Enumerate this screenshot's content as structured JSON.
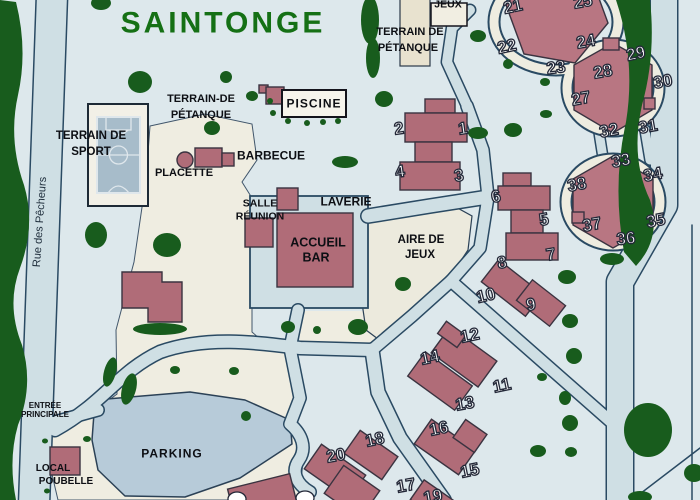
{
  "map": {
    "title": "SAINTONGE",
    "street_name": "Rue des Pêcheurs",
    "labels": {
      "petanque_top": {
        "line1": "TERRAIN DE",
        "line2": "PÉTANQUE"
      },
      "jeux_box": "JEUX",
      "piscine": "PISCINE",
      "petanque_left": {
        "line1": "TERRAIN-DE",
        "line2": "PÉTANQUE"
      },
      "terrain_sport": {
        "line1": "TERRAIN DE",
        "line2": "SPORT"
      },
      "barbecue": "BARBECUE",
      "placette": "PLACETTE",
      "salle_reunion": {
        "line1": "SALLE",
        "line2": "RÉUNION"
      },
      "laverie": "LAVERIE",
      "accueil_bar": {
        "line1": "ACCUEIL",
        "line2": "BAR"
      },
      "aire_de_jeux": {
        "line1": "AIRE DE",
        "line2": "JEUX"
      },
      "entree": {
        "line1": "ENTRÉE",
        "line2": "PRINCIPALE"
      },
      "local_poubelle": {
        "line1": "LOCAL",
        "line2": "POUBELLE"
      },
      "parking": "PARKING"
    },
    "colors": {
      "background": "#dde8ec",
      "zone_cream": "#efede1",
      "road_fill": "#cfdfe4",
      "road_casing": "#2a4a63",
      "parking_fill": "#b7cbd9",
      "building_fill": "#b06c78",
      "building_hex_fill": "#b87682",
      "tree_green": "#185c1d",
      "title_green": "#157015",
      "number_fill": "#ffffff",
      "number_outline": "#232838"
    },
    "sites": [
      {
        "n": "1",
        "x": 463,
        "y": 129,
        "r": -8
      },
      {
        "n": "2",
        "x": 399,
        "y": 129,
        "r": -8
      },
      {
        "n": "3",
        "x": 459,
        "y": 176,
        "r": -8
      },
      {
        "n": "4",
        "x": 400,
        "y": 172,
        "r": -8
      },
      {
        "n": "5",
        "x": 544,
        "y": 220,
        "r": -10
      },
      {
        "n": "6",
        "x": 496,
        "y": 197,
        "r": -10
      },
      {
        "n": "7",
        "x": 551,
        "y": 255,
        "r": -10
      },
      {
        "n": "8",
        "x": 502,
        "y": 263,
        "r": -10
      },
      {
        "n": "9",
        "x": 531,
        "y": 305,
        "r": -10
      },
      {
        "n": "10",
        "x": 486,
        "y": 296,
        "r": -14
      },
      {
        "n": "11",
        "x": 502,
        "y": 386,
        "r": -12
      },
      {
        "n": "12",
        "x": 470,
        "y": 336,
        "r": -12
      },
      {
        "n": "13",
        "x": 465,
        "y": 404,
        "r": -10
      },
      {
        "n": "14",
        "x": 430,
        "y": 358,
        "r": -12
      },
      {
        "n": "15",
        "x": 470,
        "y": 471,
        "r": -12
      },
      {
        "n": "16",
        "x": 439,
        "y": 429,
        "r": -12
      },
      {
        "n": "17",
        "x": 406,
        "y": 486,
        "r": -10
      },
      {
        "n": "18",
        "x": 375,
        "y": 440,
        "r": -12
      },
      {
        "n": "19",
        "x": 433,
        "y": 497,
        "r": -10
      },
      {
        "n": "20",
        "x": 336,
        "y": 456,
        "r": -10
      },
      {
        "n": "21",
        "x": 513,
        "y": 7,
        "r": -12
      },
      {
        "n": "22",
        "x": 507,
        "y": 47,
        "r": -12
      },
      {
        "n": "23",
        "x": 556,
        "y": 68,
        "r": -8
      },
      {
        "n": "24",
        "x": 586,
        "y": 42,
        "r": -10
      },
      {
        "n": "25",
        "x": 583,
        "y": 2,
        "r": -10
      },
      {
        "n": "27",
        "x": 581,
        "y": 99,
        "r": -10
      },
      {
        "n": "28",
        "x": 603,
        "y": 72,
        "r": -10
      },
      {
        "n": "29",
        "x": 636,
        "y": 54,
        "r": -12
      },
      {
        "n": "30",
        "x": 663,
        "y": 82,
        "r": -10
      },
      {
        "n": "31",
        "x": 648,
        "y": 127,
        "r": -10
      },
      {
        "n": "32",
        "x": 609,
        "y": 131,
        "r": -10
      },
      {
        "n": "33",
        "x": 621,
        "y": 161,
        "r": -10
      },
      {
        "n": "34",
        "x": 653,
        "y": 175,
        "r": -10
      },
      {
        "n": "35",
        "x": 656,
        "y": 221,
        "r": -10
      },
      {
        "n": "36",
        "x": 626,
        "y": 239,
        "r": -6
      },
      {
        "n": "37",
        "x": 592,
        "y": 225,
        "r": -10
      },
      {
        "n": "38",
        "x": 577,
        "y": 185,
        "r": -10
      }
    ]
  }
}
